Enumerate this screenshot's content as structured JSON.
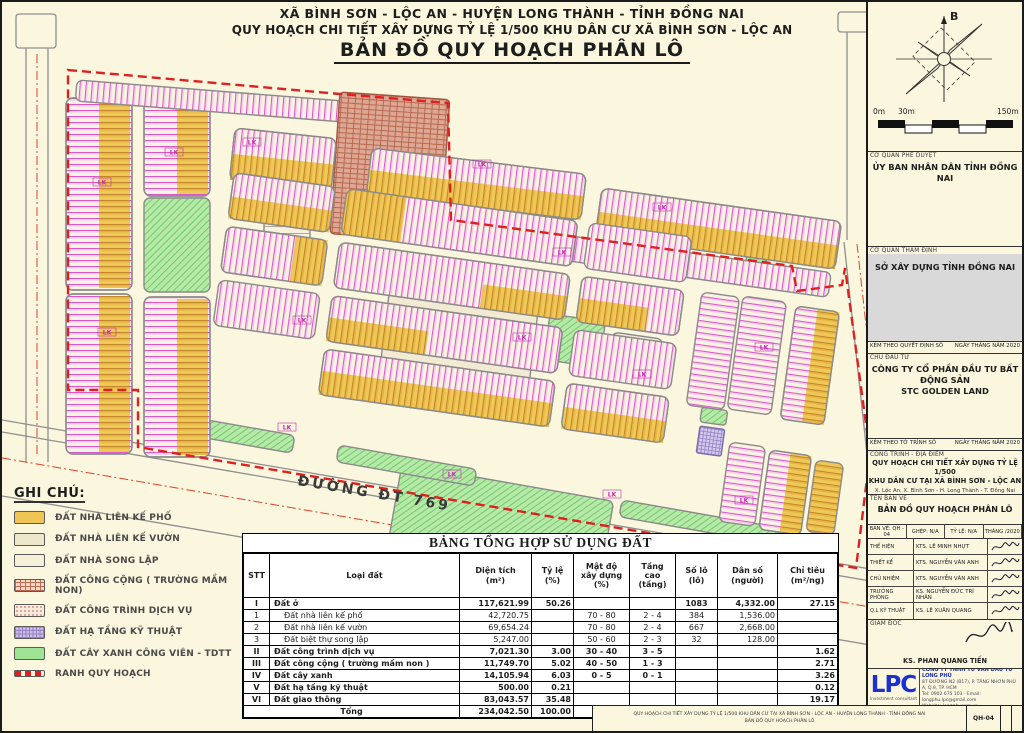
{
  "colors": {
    "boundary_red": "#E02020",
    "lot_line_magenta": "#D958C8",
    "lot_yellow": "#EFC554",
    "park_green": "#9FE394",
    "public_brick": "#D9A08C",
    "infrastructure_purple": "#CDBCE8",
    "lpc_blue": "#1B2FD4",
    "paper_cream": "#FBF7DF"
  },
  "title": {
    "line1": "XÃ BÌNH SƠN - LỘC AN - HUYỆN LONG THÀNH - TỈNH ĐỒNG NAI",
    "line2": "QUY HOẠCH CHI TIẾT XÂY DỰNG TỶ LỆ 1/500 KHU DÂN CƯ XÃ BÌNH SƠN - LỘC AN",
    "line3": "BẢN ĐỒ QUY HOẠCH PHÂN LÔ"
  },
  "map": {
    "road_label": "ĐƯỜNG ĐT 769",
    "north_label": "B",
    "scale_ticks": [
      "0m",
      "30m",
      "150m"
    ],
    "lot_tag": "LK"
  },
  "legend": {
    "heading": "GHI CHÚ:",
    "items": [
      {
        "label": "ĐẤT NHÀ LIÊN KẾ PHỐ",
        "swatch": "yellow"
      },
      {
        "label": "ĐẤT NHÀ LIÊN KẾ VƯỜN",
        "swatch": "cream"
      },
      {
        "label": "ĐẤT NHÀ SONG LẬP",
        "swatch": "pale"
      },
      {
        "label": "ĐẤT CÔNG CỘNG ( TRƯỜNG MẦM NON)",
        "swatch": "brick"
      },
      {
        "label": "ĐẤT CÔNG TRÌNH DỊCH VỤ",
        "swatch": "dots"
      },
      {
        "label": "ĐẤT HẠ TẦNG KỸ THUẬT",
        "swatch": "purple"
      },
      {
        "label": "ĐẤT CÂY XANH CÔNG VIÊN - TDTT",
        "swatch": "green"
      },
      {
        "label": "RANH QUY HOẠCH",
        "swatch": "boundary"
      }
    ]
  },
  "table": {
    "title": "BẢNG TỔNG HỢP SỬ DỤNG ĐẤT",
    "headers": [
      "STT",
      "Loại đất",
      "Diện tích\n(m²)",
      "Tỷ lệ\n(%)",
      "Mật độ\nxây dựng\n(%)",
      "Tầng\ncao\n(tầng)",
      "Số lô\n(lô)",
      "Dân số\n(người)",
      "Chỉ tiêu\n(m²/ng)"
    ],
    "rows": [
      {
        "stt": "I",
        "name": "Đất ở",
        "area": "117,621.99",
        "ratio": "50.26",
        "density": "",
        "floors": "",
        "lots": "1083",
        "pop": "4,332.00",
        "quota": "27.15",
        "bold": true,
        "indent": false,
        "total": false
      },
      {
        "stt": "1",
        "name": "Đất nhà liên kế phố",
        "area": "42,720.75",
        "ratio": "",
        "density": "70 - 80",
        "floors": "2 - 4",
        "lots": "384",
        "pop": "1,536.00",
        "quota": "",
        "bold": false,
        "indent": true,
        "total": false
      },
      {
        "stt": "2",
        "name": "Đất nhà liên kế vườn",
        "area": "69,654.24",
        "ratio": "",
        "density": "70 - 80",
        "floors": "2 - 4",
        "lots": "667",
        "pop": "2,668.00",
        "quota": "",
        "bold": false,
        "indent": true,
        "total": false
      },
      {
        "stt": "3",
        "name": "Đất biệt thự song lập",
        "area": "5,247.00",
        "ratio": "",
        "density": "50 - 60",
        "floors": "2 - 3",
        "lots": "32",
        "pop": "128.00",
        "quota": "",
        "bold": false,
        "indent": true,
        "total": false
      },
      {
        "stt": "II",
        "name": "Đất công trình dịch vụ",
        "area": "7,021.30",
        "ratio": "3.00",
        "density": "30 - 40",
        "floors": "3 - 5",
        "lots": "",
        "pop": "",
        "quota": "1.62",
        "bold": true,
        "indent": false,
        "total": false
      },
      {
        "stt": "III",
        "name": "Đất công cộng ( trường mầm non )",
        "area": "11,749.70",
        "ratio": "5.02",
        "density": "40 - 50",
        "floors": "1 - 3",
        "lots": "",
        "pop": "",
        "quota": "2.71",
        "bold": true,
        "indent": false,
        "total": false
      },
      {
        "stt": "IV",
        "name": "Đất cây xanh",
        "area": "14,105.94",
        "ratio": "6.03",
        "density": "0 - 5",
        "floors": "0 - 1",
        "lots": "",
        "pop": "",
        "quota": "3.26",
        "bold": true,
        "indent": false,
        "total": false
      },
      {
        "stt": "V",
        "name": "Đất hạ tầng kỹ thuật",
        "area": "500.00",
        "ratio": "0.21",
        "density": "",
        "floors": "",
        "lots": "",
        "pop": "",
        "quota": "0.12",
        "bold": true,
        "indent": false,
        "total": false
      },
      {
        "stt": "VI",
        "name": "Đất giao thông",
        "area": "83,043.57",
        "ratio": "35.48",
        "density": "",
        "floors": "",
        "lots": "",
        "pop": "",
        "quota": "19.17",
        "bold": true,
        "indent": false,
        "total": false
      },
      {
        "stt": "",
        "name": "Tổng",
        "area": "234,042.50",
        "ratio": "100.00",
        "density": "",
        "floors": "",
        "lots": "1083",
        "pop": "4,332.00",
        "quota": "54.03",
        "bold": true,
        "indent": false,
        "total": true
      }
    ]
  },
  "sidebar": {
    "approve_label": "CƠ QUAN PHÊ DUYỆT",
    "approve_value": "ỦY BAN NHÂN DÂN TỈNH ĐỒNG NAI",
    "review_label": "CƠ QUAN THẨM ĐỊNH",
    "review_value": "SỞ XÂY DỰNG TỈNH ĐỒNG NAI",
    "decision_line": "KÈM THEO QUYẾT ĐỊNH SỐ",
    "decision_date": "NGÀY      THÁNG      NĂM 2020",
    "investor_label": "CHỦ ĐẦU TƯ",
    "investor_value": "CÔNG TY CỔ PHẦN ĐẦU TƯ BẤT ĐỘNG SẢN\nSTC GOLDEN LAND",
    "report_line": "KÈM THEO TỜ TRÌNH SỐ",
    "report_date": "NGÀY      THÁNG      NĂM 2020",
    "project_label": "CÔNG TRÌNH - ĐỊA ĐIỂM",
    "project_name": "QUY HOẠCH CHI TIẾT XÂY DỰNG TỶ LỆ 1/500\nKHU DÂN CƯ TẠI XÃ BÌNH SƠN - LỘC AN",
    "project_location": "X. Lộc An, X. Bình Sơn - H. Long Thành - T. Đồng Nai",
    "drawing_label": "TÊN BẢN VẼ",
    "drawing_name": "BẢN ĐỒ QUY HOẠCH PHÂN LÔ",
    "meta": [
      "BẢN VẼ:  QH - 04",
      "GHÉP: N/A",
      "TỶ LỆ: N/A",
      "THÁNG      /2020"
    ],
    "signers": [
      {
        "role": "THỂ HIỆN",
        "name": "KTS. LÊ MINH NHỰT"
      },
      {
        "role": "THIẾT KẾ",
        "name": "KTS. NGUYỄN VĂN ANH"
      },
      {
        "role": "CHỦ NHIỆM",
        "name": "KTS. NGUYỄN VĂN ANH"
      },
      {
        "role": "TRƯỞNG PHÒNG",
        "name": "KS. NGUYỄN ĐỨC TRÍ NHÂN"
      },
      {
        "role": "Q.L KỸ THUẬT",
        "name": "KS. LÊ XUÂN QUANG"
      }
    ],
    "director_label": "GIÁM ĐỐC",
    "director_name": "KS. PHAN QUANG TIẾN",
    "company": {
      "logo": "LPC",
      "logo_sub": "Investment consultant",
      "name": "CÔNG TY TNHH TƯ VẤN ĐẦU TƯ LONG PHÚ",
      "address": "87 ĐƯỜNG N2 (B17), P. TĂNG NHƠN PHÚ A, Q.9, TP. HCM",
      "contact": "Tel: 0902 675 103  -  Email: longphu.lpc@gmail.com",
      "website": "Website: longphucorp.vn"
    }
  },
  "footer": {
    "line1": "QUY HOẠCH CHI TIẾT XÂY DỰNG TỶ LỆ 1/500 KHU DÂN CƯ TẠI XÃ BÌNH SƠN - LỘC AN - HUYỆN LONG THÀNH - TỈNH ĐỒNG NAI",
    "line2": "BẢN ĐỒ QUY HOẠCH PHÂN LÔ",
    "code": "QH-04"
  }
}
